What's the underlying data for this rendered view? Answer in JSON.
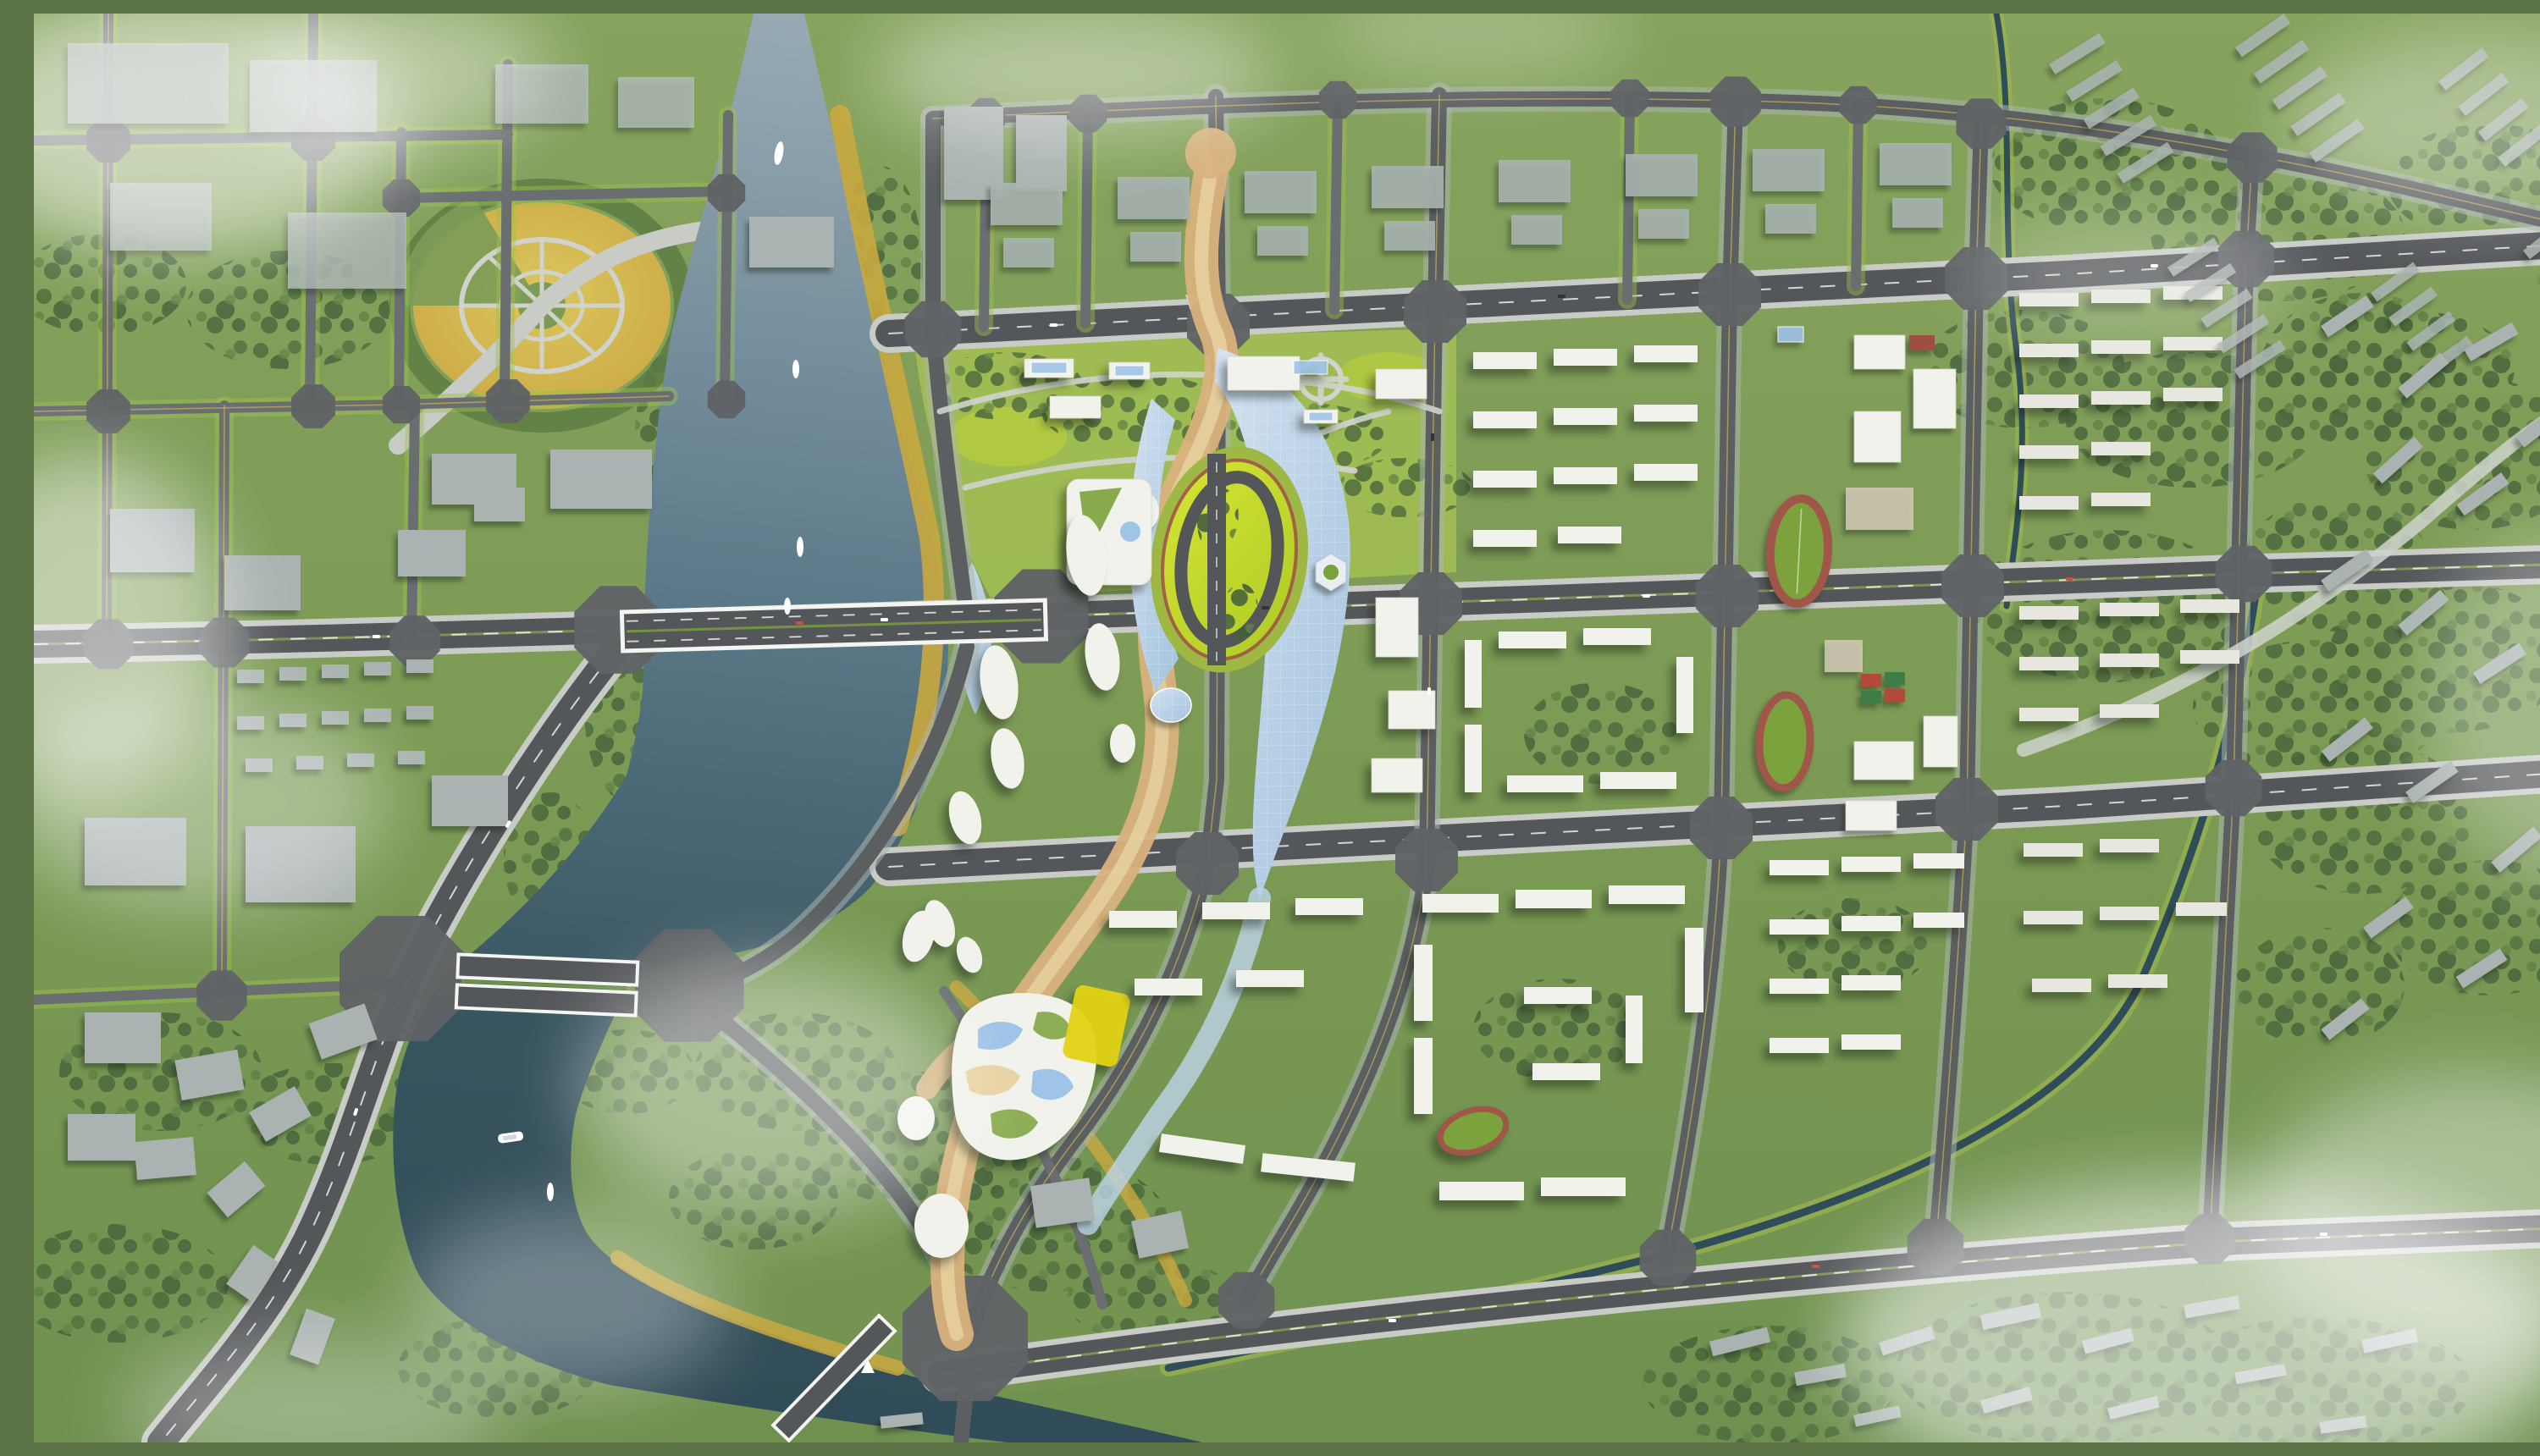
{
  "scene": {
    "title": "Riverfront new-town urban master plan — aerial rendering",
    "description": "Top-down bird's-eye architectural visualization of a planned riverfront district: an S-curving river crossed by three bridges, a central business district under a leaf-shaped light-blue glass canopy wrapped around an oval ring park, an orange pedestrian promenade threading north to south, a golden radial meadow park in the north-west, school campuses with running tracks and tennis courts, white new residential blocks to the east, flat gray industrial halls to the west, existing gray housing estates on the outskirts, and drifting fog patches."
  },
  "palette": {
    "base_green": "#7c9b56",
    "meadow_green": "#a9c452",
    "bright_lawn": "#c6d92e",
    "tree_dark": "#44603a",
    "tree_mid": "#5d7d43",
    "street_tree": "#9cc14e",
    "water_light": "#98abb5",
    "water_dark": "#2f4b57",
    "road_dark": "#54575a",
    "road_mid": "#6a6e70",
    "sidewalk": "#c8cbc6",
    "intersection": "#606467",
    "building_gray": "#aab3b1",
    "building_white": "#f2f2ec",
    "canopy_blue": "#bdd4ea",
    "skylight_blue": "#9fc4e8",
    "promenade": "#d9b27c",
    "promenade_light": "#e9d3a4",
    "gold_field": "#c9a83f",
    "track_red": "#a05648",
    "track_field": "#7ba23c",
    "court_red": "#b24a3c",
    "court_green": "#3e7d46",
    "canal_teal": "#2f4d59"
  },
  "features": {
    "river": {
      "label": "S-curved river",
      "boats": 7
    },
    "bridges": [
      "main east-west bridge",
      "twin-deck west bridge",
      "south diagonal bridge"
    ],
    "central_district": {
      "label": "CBD core",
      "landmarks": [
        "leaf-shaped glass canopy",
        "oval ring park with loop road",
        "ring building",
        "hexagonal pavilion",
        "organic cultural center",
        "orange promenade",
        "white blob pavilions along riverbank"
      ]
    },
    "parks": {
      "golden_circle_park": "radial golden meadow park with concentric paths",
      "linear_park": "winding-path park band north of the core",
      "peninsula": "wooded river-bend peninsula"
    },
    "sports": {
      "running_tracks": 3,
      "tennis_courts": 4
    },
    "districts": [
      "western industrial halls",
      "eastern white residential blocks",
      "two school campuses",
      "existing gray housing outskirts"
    ],
    "atmosphere": {
      "fog_patches": 14,
      "lighting": "overcast daylight, soft shadows to lower-left"
    }
  }
}
